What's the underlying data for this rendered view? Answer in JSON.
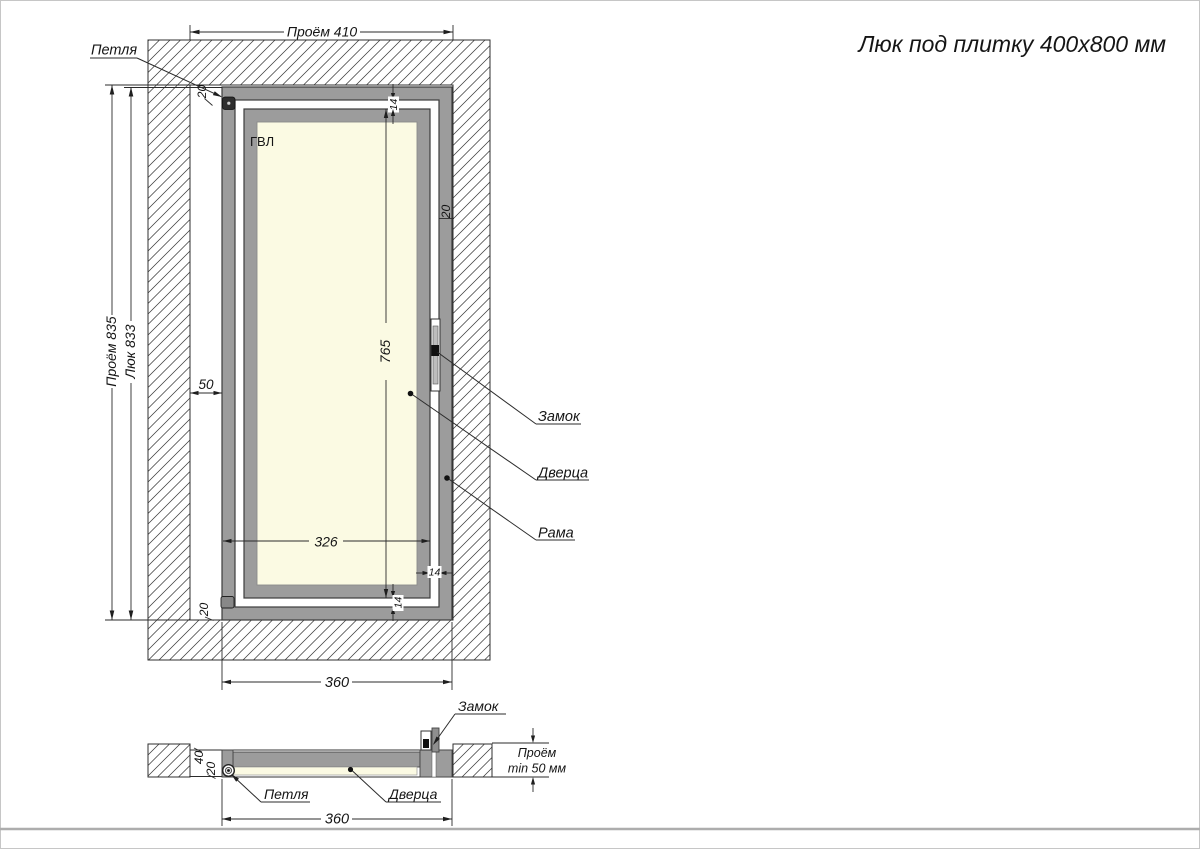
{
  "title": "Люк под плитку 400х800 мм",
  "main": {
    "material_label": "ГВЛ",
    "dim_opening_width": "Проём 410",
    "dim_opening_height": "Проём 835",
    "dim_hatch_height": "Люк 833",
    "dim_side_gap": "50",
    "dim_door_height": "765",
    "dim_panel_width": "326",
    "dim_width": "360",
    "dim_frame_top": "20",
    "dim_frame_right": "20",
    "dim_frame_bottom": "20",
    "dim_gap_top": "14",
    "dim_gap_right": "14",
    "dim_gap_bottom": "14",
    "label_hinge": "Петля",
    "label_lock": "Замок",
    "label_door": "Дверца",
    "label_frame": "Рама"
  },
  "section": {
    "label_lock": "Замок",
    "label_hinge": "Петля",
    "label_door": "Дверца",
    "dim_depth": "40",
    "dim_door_thickness": "20",
    "dim_opening_depth_line1": "Проём",
    "dim_opening_depth_line2": "min 50 мм",
    "dim_width": "360"
  },
  "colors": {
    "frame_gray": "#9C9C9C",
    "panel_cream": "#FBFAE3",
    "line_dark": "#2B2B2B",
    "hinge_dark": "#2E2E2E",
    "sheet_edge": "#ADADAD"
  }
}
